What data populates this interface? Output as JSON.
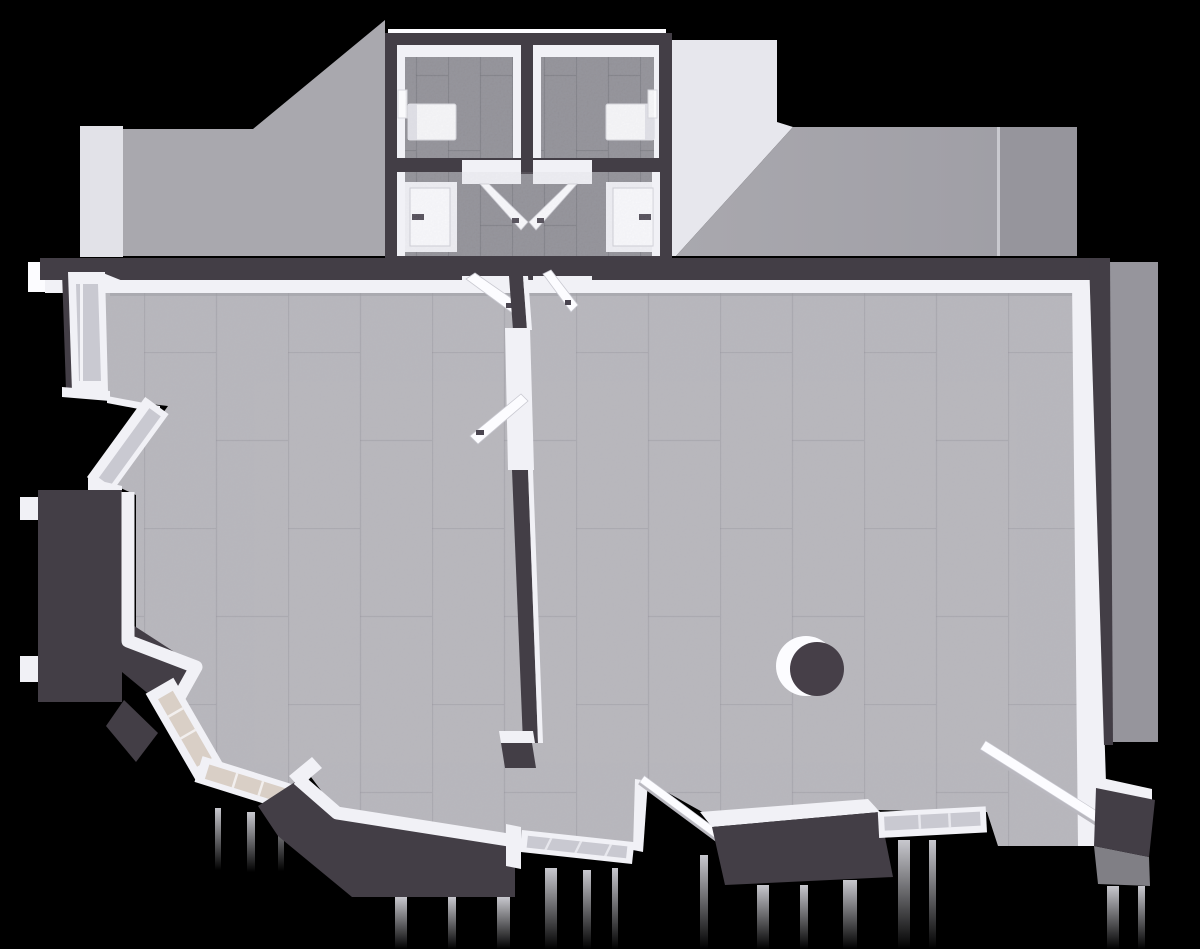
{
  "palette": {
    "background": "#000000",
    "wall_dark": "#433e46",
    "wall_soft": "#4a4450",
    "trim_white": "#f1f1f6",
    "trim_bright": "#fcfcff",
    "floor_main": "#b6b5bb",
    "floor_annex": "#8e8d94",
    "tile_line": "#7f7e86",
    "glass_cool": "#c9c9d1",
    "glass_warm": "#d9cfc6",
    "shadow_light": "#e7e7ed",
    "shadow_mid": "#a9a8ae",
    "shadow_deep": "#96959c",
    "fixture": "#fafafc",
    "handle": "#4a4550",
    "column_dark": "#463f48"
  },
  "scene": {
    "view": "top-down-3d-floorplan",
    "bathrooms": 2,
    "toilet_fixtures": 2,
    "closed_side_doors": 2,
    "open_door_leaves": 6,
    "windows": 6,
    "window_sills": 2,
    "round_columns": 1,
    "main_rooms": 2,
    "element_names": [
      "cast-shadow-left",
      "light-patch-left",
      "light-patch-right",
      "cast-shadow-right",
      "cast-shadow-right-wall",
      "annex-bathroom-left",
      "annex-bathroom-right",
      "toilet-fixture-left",
      "toilet-fixture-right",
      "vestibule",
      "side-door-left",
      "side-door-right",
      "double-door-leaf-left",
      "double-door-leaf-right",
      "door-leaf-into-left-room",
      "door-leaf-into-right-room",
      "divider-wall",
      "divider-door-leaf",
      "window-left-vertical",
      "window-left-diagonal",
      "window-lower-left-steep",
      "window-lower-left-shallow",
      "window-bottom-center",
      "window-bottom-right",
      "sill-bottom-diagonal",
      "leaning-panel-right-wall",
      "round-column",
      "left-room-floor",
      "right-room-floor"
    ]
  }
}
